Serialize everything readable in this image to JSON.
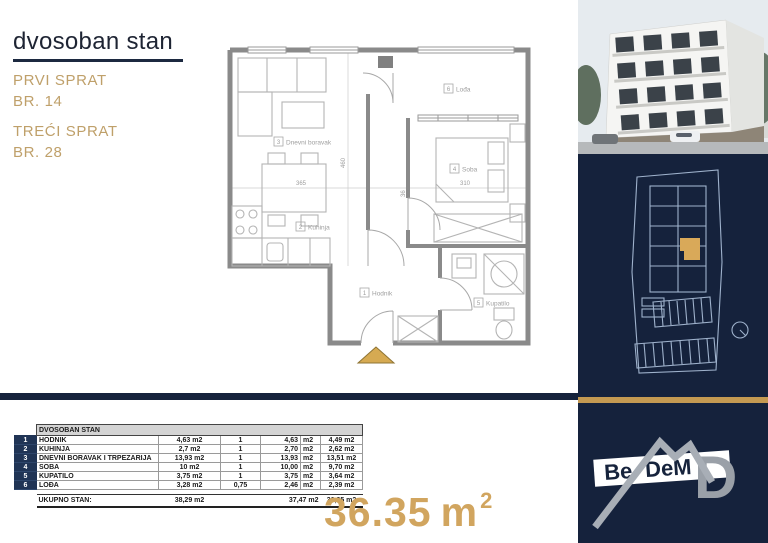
{
  "header": {
    "title": "dvosoban stan",
    "floor1_label": "PRVI SPRAT",
    "floor1_number": "BR. 14",
    "floor2_label": "TREĆI SPRAT",
    "floor2_number": "BR. 28"
  },
  "floor_plan": {
    "rooms": {
      "hodnik": {
        "num": "1",
        "label": "Hodnik"
      },
      "kuhinja": {
        "num": "2",
        "label": "Kuhinja"
      },
      "dnevni": {
        "num": "3",
        "label": "Dnevni boravak"
      },
      "soba": {
        "num": "4",
        "label": "Soba"
      },
      "kupatilo": {
        "num": "5",
        "label": "Kupatilo"
      },
      "lodja": {
        "num": "6",
        "label": "Lođa"
      }
    },
    "dimensions": {
      "living_width": "365",
      "plan_depth": "460",
      "bedroom_width": "310",
      "wall": "36"
    }
  },
  "area_table": {
    "title": "DVOSOBAN STAN",
    "rows": [
      {
        "num": "1",
        "name": "HODNIK",
        "area": "4,63 m2",
        "coef": "1",
        "value": "4,63",
        "unit": "m2",
        "reduced": "4,49 m2"
      },
      {
        "num": "2",
        "name": "KUHINJA",
        "area": "2,7 m2",
        "coef": "1",
        "value": "2,70",
        "unit": "m2",
        "reduced": "2,62 m2"
      },
      {
        "num": "3",
        "name": "DNEVNI BORAVAK I TRPEZARIJA",
        "area": "13,93 m2",
        "coef": "1",
        "value": "13,93",
        "unit": "m2",
        "reduced": "13,51 m2"
      },
      {
        "num": "4",
        "name": "SOBA",
        "area": "10 m2",
        "coef": "1",
        "value": "10,00",
        "unit": "m2",
        "reduced": "9,70 m2"
      },
      {
        "num": "5",
        "name": "KUPATILO",
        "area": "3,75 m2",
        "coef": "1",
        "value": "3,75",
        "unit": "m2",
        "reduced": "3,64 m2"
      },
      {
        "num": "6",
        "name": "LOĐA",
        "area": "3,28 m2",
        "coef": "0,75",
        "value": "2,46",
        "unit": "m2",
        "reduced": "2,39 m2"
      }
    ],
    "total_label": "UKUPNO STAN:",
    "total_area": "38,29 m2",
    "total_value": "37,47 m2",
    "total_reduced": "36,35 m2"
  },
  "summary": {
    "value": "36.35",
    "unit": "m",
    "sup": "2"
  },
  "logo": {
    "be": "Be",
    "dem": "DeM",
    "d": "D"
  },
  "colors": {
    "navy": "#15223c",
    "gold": "#c49a52",
    "gold_text": "#d1a55f",
    "plan_gray": "#8a8a8a"
  }
}
